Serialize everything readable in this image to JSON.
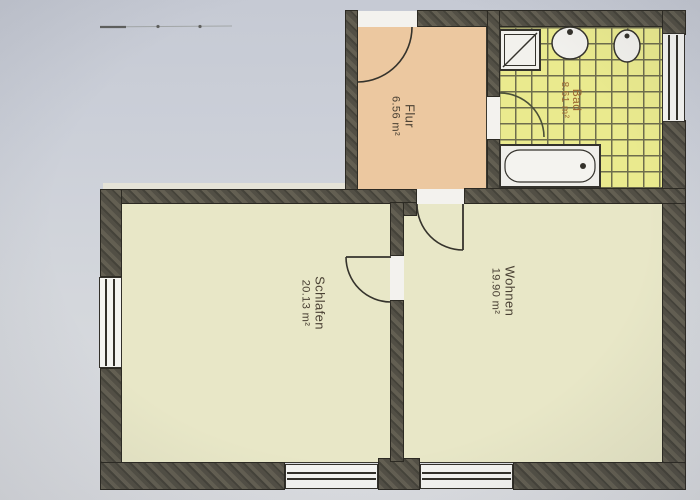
{
  "plan": {
    "kind": "apartment-floor-plan-photo",
    "rooms": [
      {
        "name": "Flur",
        "area": "6.56 m²"
      },
      {
        "name": "Bad",
        "area": "8.61 m²"
      },
      {
        "name": "Wohnen",
        "area": "19.90 m²"
      },
      {
        "name": "Schlafen",
        "area": "20.13 m²"
      }
    ],
    "fixtures": [
      "shower",
      "washbasin",
      "toilet",
      "bathtub"
    ],
    "doors": [
      "entrance-door",
      "bath-door",
      "living-room-door",
      "bedroom-door"
    ],
    "windows": [
      "bath-window",
      "bedroom-left-window",
      "bedroom-bottom-window",
      "living-room-bottom-window"
    ],
    "palette": {
      "paper": "#cdd0d8",
      "wall": "#56534a",
      "flur_floor": "#ecc8a0",
      "bad_floor": "#eaea8e",
      "room_floor": "#e8e7c7",
      "window_white": "#f4f4f1",
      "label_text": "#4a4134",
      "bad_label_text": "#9c6a33"
    }
  }
}
